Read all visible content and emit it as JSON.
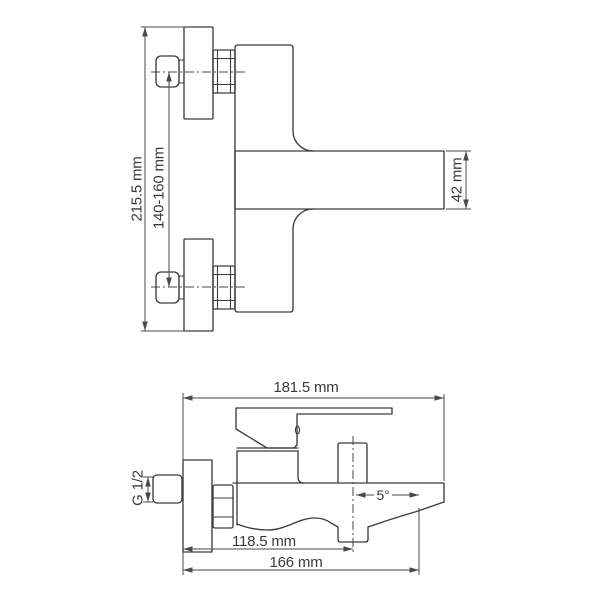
{
  "drawing": {
    "type": "technical-installation-drawing",
    "subject": "wall-mounted bath mixer faucet, two orthographic views",
    "front_view": {
      "dim_overall_height": "215.5 mm",
      "dim_connection_centers": "140-160 mm",
      "dim_spout_height": "42 mm"
    },
    "side_view": {
      "dim_overall_length": "181.5 mm",
      "dim_spout_angle": "5°",
      "dim_spout_reach": "118.5 mm",
      "dim_overall_reach": "166 mm",
      "dim_thread": "G 1/2"
    },
    "colors": {
      "outline": "#3c3c3c",
      "dimension_lines": "#4a4a4a",
      "text": "#3a3a3a",
      "background": "#ffffff"
    }
  }
}
